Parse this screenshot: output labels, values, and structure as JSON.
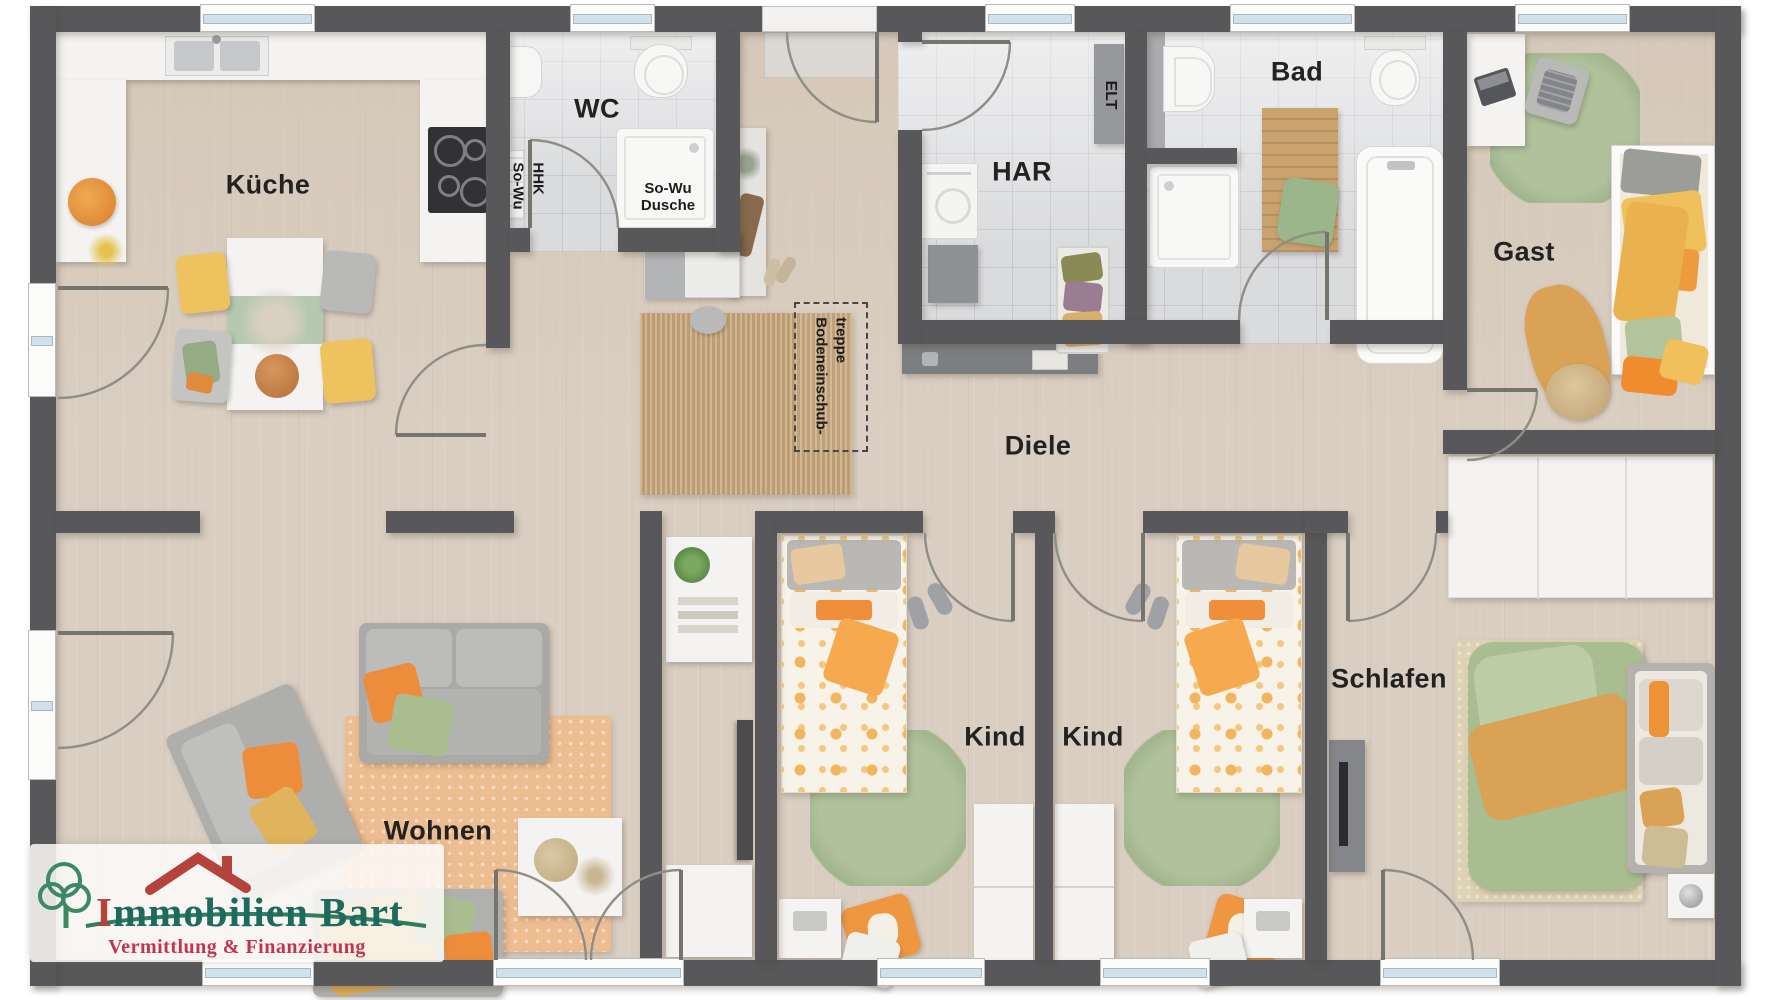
{
  "meta": {
    "title": "Grundriss Bungalow – Immobilien Bart",
    "width": 1778,
    "height": 1000
  },
  "palette": {
    "wall": "#58585a",
    "wood_floor": "#d9cec1",
    "tile_floor": "#dadbdd",
    "accent_orange": "#ef9640",
    "accent_green": "#a9bd95",
    "accent_mustard": "#d9a254",
    "glass_blue": "#cfe2ec",
    "logo_green": "#1d6a5e",
    "logo_red": "#b5433b",
    "logo_pink": "#c13550"
  },
  "rooms": {
    "kueche": "Küche",
    "wc": "WC",
    "har": "HAR",
    "bad": "Bad",
    "gast": "Gast",
    "diele": "Diele",
    "wohnen": "Wohnen",
    "kind1": "Kind",
    "kind2": "Kind",
    "schlafen": "Schlafen"
  },
  "annotations": {
    "so_wu_hhk_line1": "So-Wu",
    "so_wu_hhk_line2": "HHK",
    "so_wu_dusche_line1": "So-Wu",
    "so_wu_dusche_line2": "Dusche",
    "elt": "ELT",
    "attic_line1": "Bodeneinschub-",
    "attic_line2": "treppe"
  },
  "logo": {
    "name_initial": "I",
    "name_rest": "mmobilien Bart",
    "tagline": "Vermittlung & Finanzierung"
  }
}
